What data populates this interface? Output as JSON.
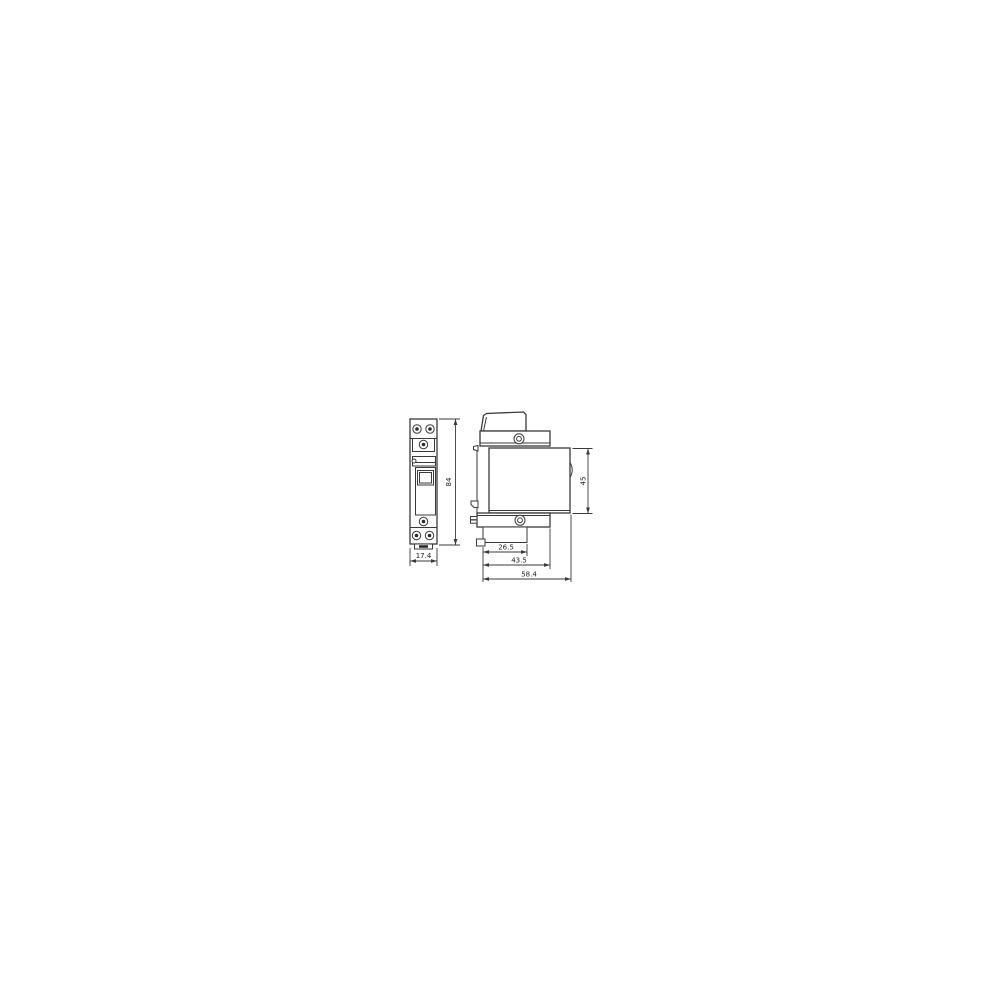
{
  "drawing": {
    "front_view": {
      "height_dim": "84",
      "width_dim": "17.4"
    },
    "side_view": {
      "front_height_dim": "45",
      "depth_step_1_dim": "26.5",
      "depth_step_2_dim": "43.5",
      "total_depth_dim": "58.4"
    },
    "icons": {
      "screw": "terminal-screw-icon",
      "din_claw": "din-rail-claw",
      "arrowheads": "dimension-arrowhead"
    },
    "colors": {
      "line": "#3a3a3a",
      "text": "#1c1c1c",
      "background": "#ffffff"
    }
  }
}
